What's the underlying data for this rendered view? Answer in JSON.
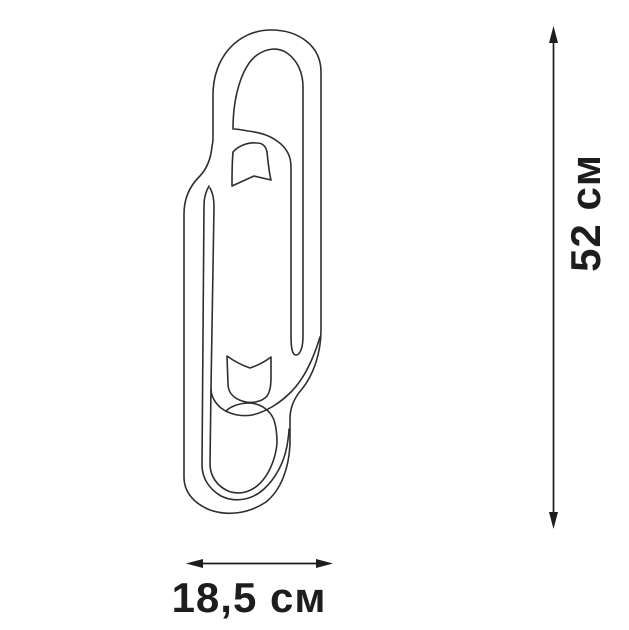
{
  "diagram": {
    "subject": "outline-drawing-of-paperclip-shaped-wall-lamp",
    "background_color": "#ffffff",
    "outline_stroke_color": "#2e2e2e",
    "annotation_color": "#1d1d1d",
    "height_dimension": {
      "label": "52 см",
      "value": 52,
      "unit": "см",
      "orientation": "vertical"
    },
    "width_dimension": {
      "label": "18,5 см",
      "value": 18.5,
      "unit": "см",
      "orientation": "horizontal"
    }
  }
}
